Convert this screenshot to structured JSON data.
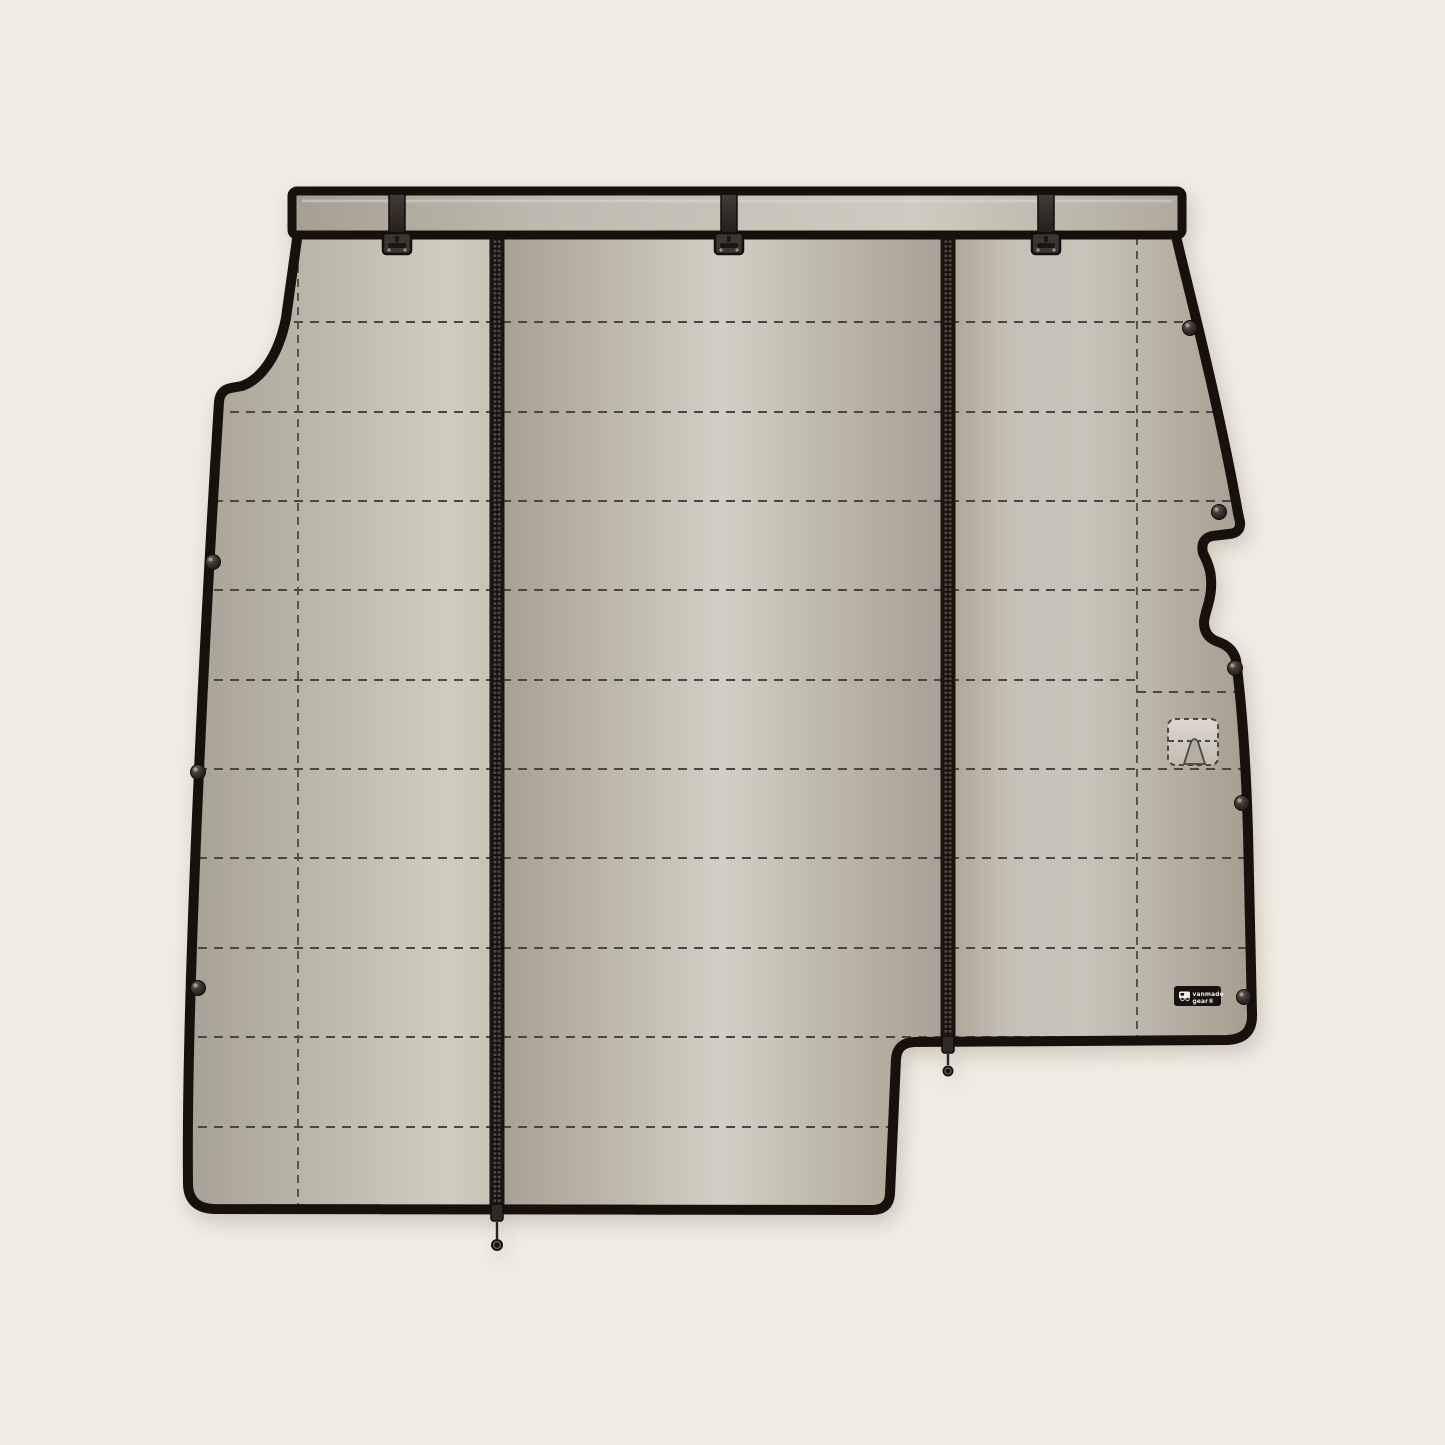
{
  "meta": {
    "title": "Van divider curtain product diagram",
    "description": "Flat illustration of a quilted van partition curtain hanging from a mounting rail, with two vertical zippers, snap fasteners, a handle cutout pocket and a brand tag"
  },
  "brand_tag": {
    "line1": "vanmade",
    "line2": "gear®"
  },
  "colors": {
    "background": "#f1ede4",
    "fabric_base": "#b2ac9f",
    "fabric_light": "#d3cfc4",
    "fabric_dark": "#a39c8f",
    "outline": "#15120e",
    "stitch": "#4b463f",
    "hardware": "#3a3631",
    "tag_background": "#14110e",
    "tag_text": "#f4f1e9"
  },
  "components": {
    "mounting_rail": 1,
    "hanging_straps": 3,
    "curtain_panels": 3,
    "zippers": 2,
    "zipper_pulls": 2,
    "snap_fasteners_left": 3,
    "snap_fasteners_right": 5,
    "handle_pocket": 1,
    "brand_tag": 1
  }
}
